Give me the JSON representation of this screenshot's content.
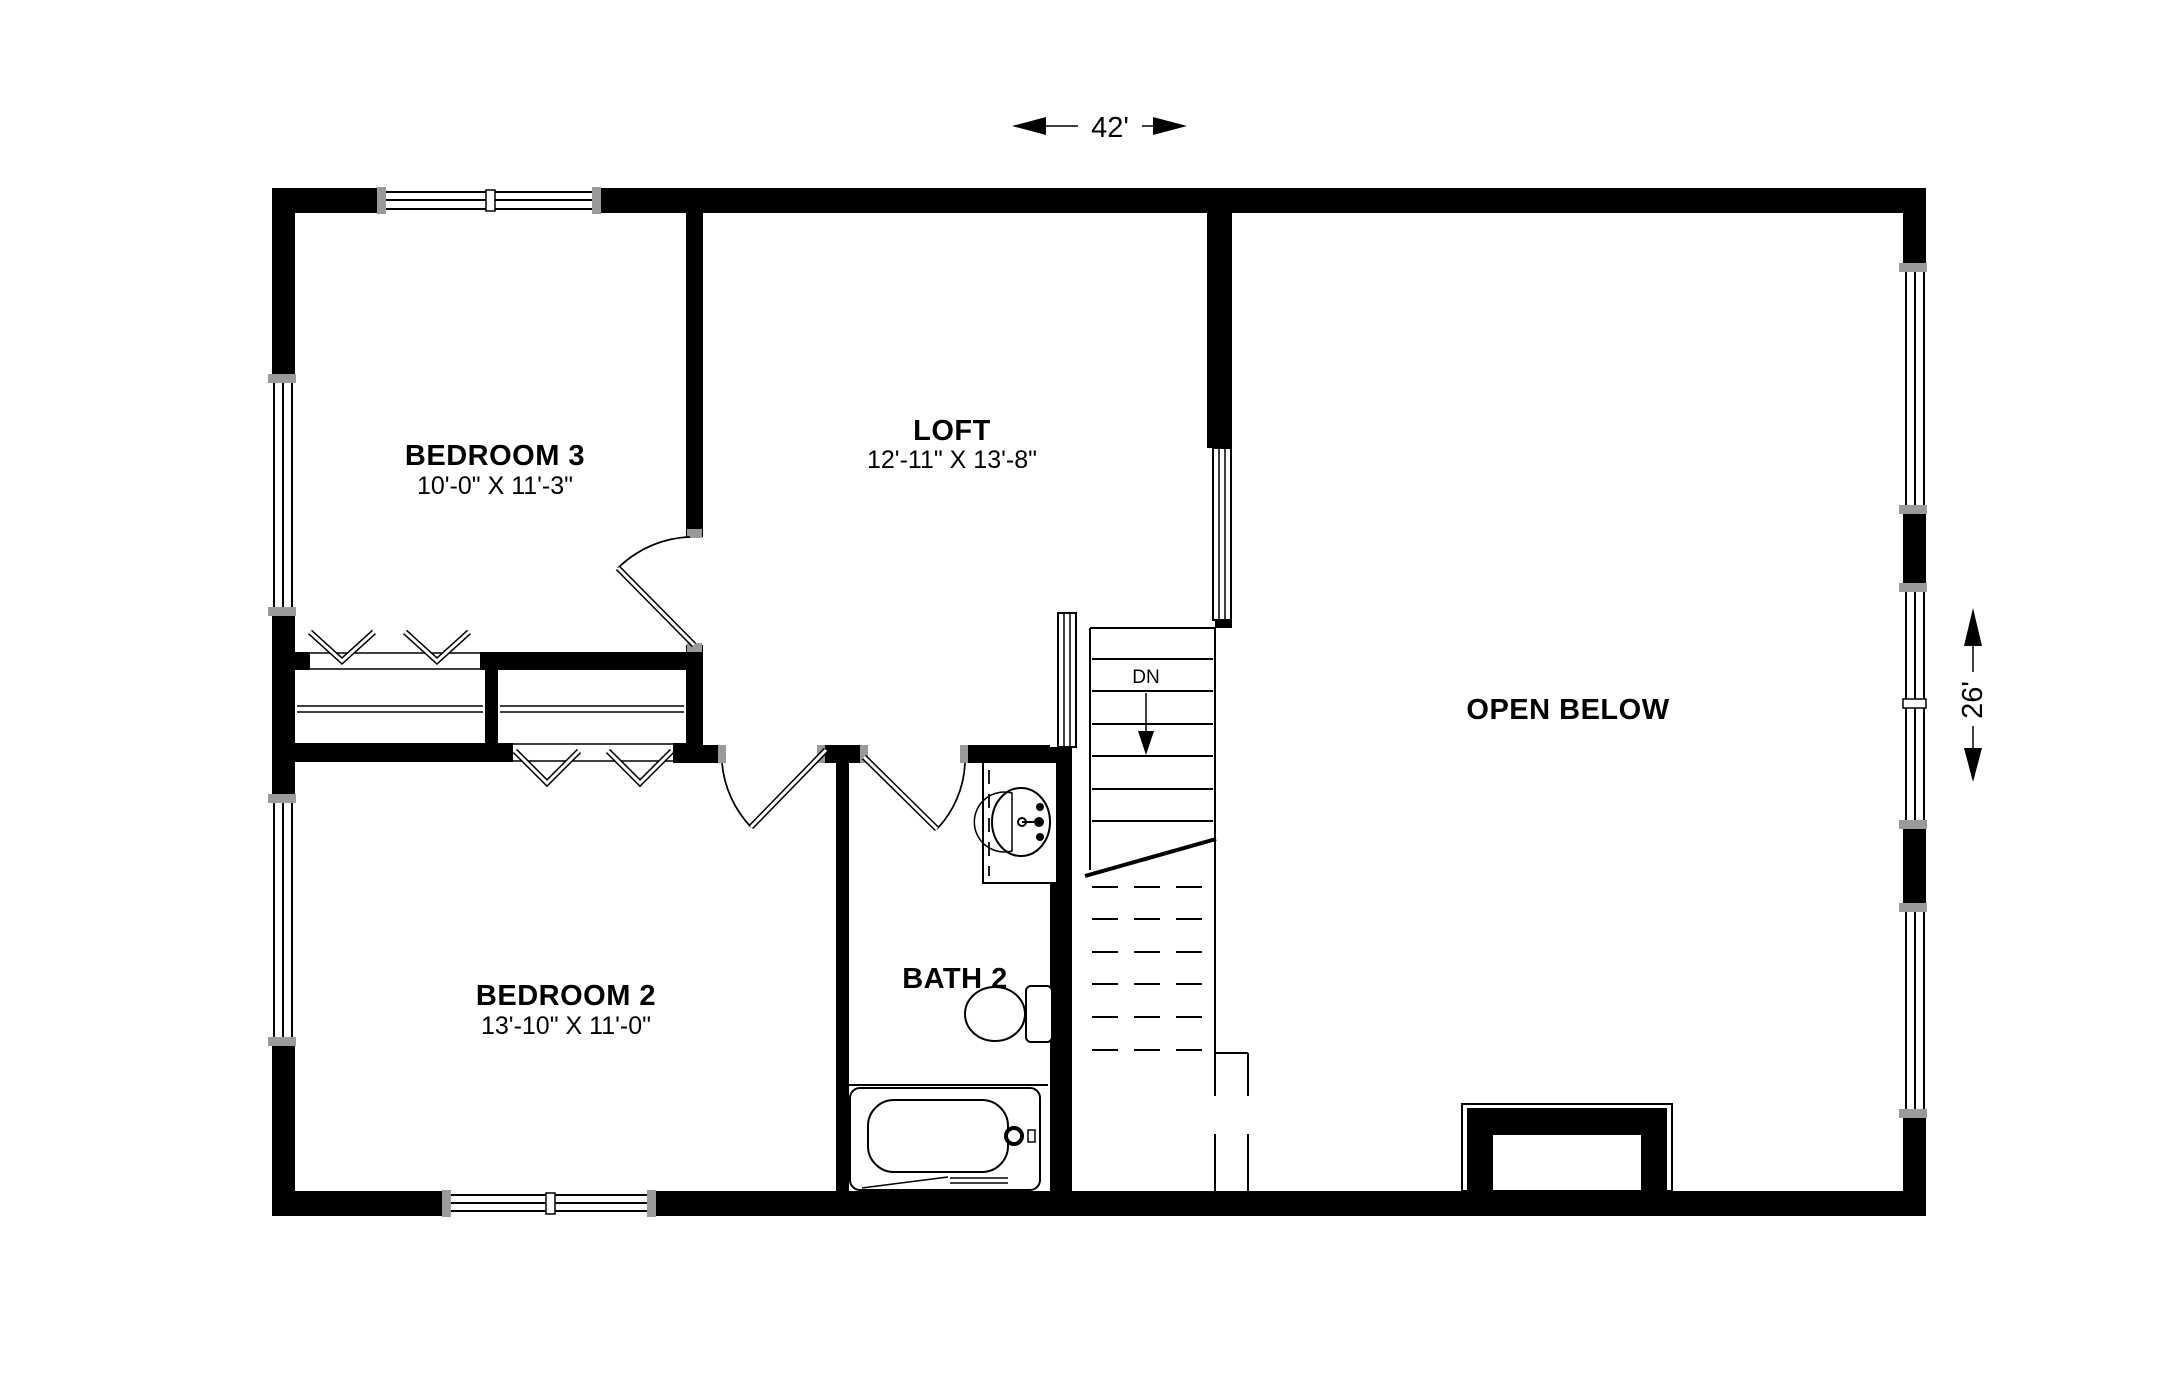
{
  "dimensions": {
    "width_label": "42'",
    "height_label": "26'"
  },
  "rooms": [
    {
      "name": "BEDROOM 3",
      "size": "10'-0\" X 11'-3\""
    },
    {
      "name": "LOFT",
      "size": "12'-11\" X 13'-8\""
    },
    {
      "name": "BEDROOM 2",
      "size": "13'-10\" X 11'-0\""
    },
    {
      "name": "BATH 2",
      "size": ""
    },
    {
      "name": "OPEN BELOW",
      "size": ""
    }
  ],
  "stairs": {
    "label": "DN"
  },
  "fixtures": [
    {
      "name": "sink"
    },
    {
      "name": "toilet"
    },
    {
      "name": "bathtub"
    }
  ],
  "colors": {
    "wall": "#000000",
    "background": "#ffffff",
    "window_marker": "#9a9a9a"
  }
}
